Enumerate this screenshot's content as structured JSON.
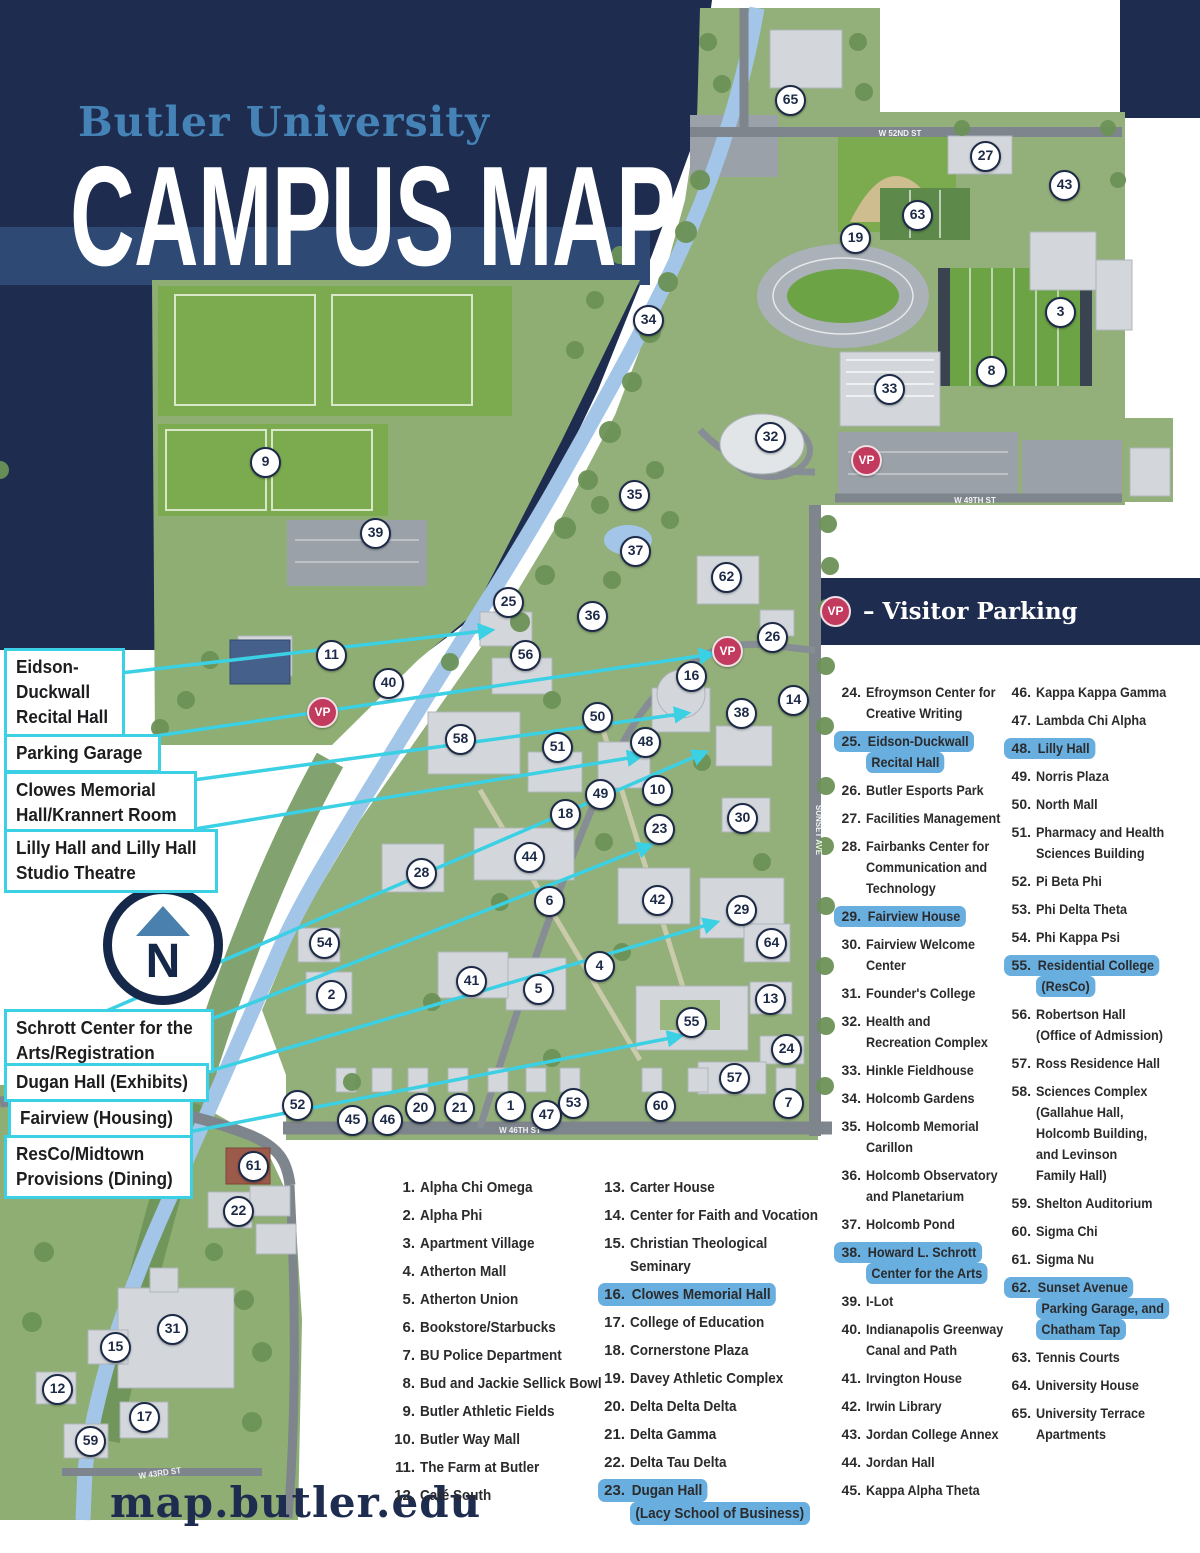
{
  "header": {
    "brand": "Butler University",
    "title": "CAMPUS MAP"
  },
  "legend_vp": {
    "badge": "VP",
    "label": "– Visitor Parking"
  },
  "compass": {
    "letter": "N"
  },
  "footer": {
    "url": "map.butler.edu"
  },
  "colors": {
    "navy": "#1e2c50",
    "band": "#2e4a74",
    "brand_blue": "#4583b6",
    "cyan": "#3bd0e3",
    "vp_red": "#c23a5e",
    "highlight": "#68aede"
  },
  "callouts": [
    {
      "name": "eidson-duckwall-recital-hall",
      "lines": [
        "Eidson-",
        "Duckwall",
        "Recital Hall"
      ],
      "x": 4,
      "y": 648,
      "line": {
        "x1": 60,
        "y1": 680,
        "x2": 492,
        "y2": 630
      }
    },
    {
      "name": "parking-garage",
      "lines": [
        "Parking Garage"
      ],
      "x": 4,
      "y": 734,
      "line": {
        "x1": 60,
        "y1": 750,
        "x2": 713,
        "y2": 654
      }
    },
    {
      "name": "clowes-memorial-hall",
      "lines": [
        "Clowes Memorial",
        "Hall/Krannert Room"
      ],
      "x": 4,
      "y": 771,
      "line": {
        "x1": 60,
        "y1": 798,
        "x2": 688,
        "y2": 713
      }
    },
    {
      "name": "lilly-hall",
      "lines": [
        "Lilly Hall and Lilly Hall",
        "Studio Theatre"
      ],
      "x": 4,
      "y": 829,
      "line": {
        "x1": 60,
        "y1": 851,
        "x2": 641,
        "y2": 756
      }
    },
    {
      "name": "schrott-center",
      "lines": [
        "Schrott Center for the",
        "Arts/Registration"
      ],
      "x": 4,
      "y": 1009,
      "line": {
        "x1": 60,
        "y1": 1031,
        "x2": 706,
        "y2": 752
      }
    },
    {
      "name": "dugan-hall",
      "lines": [
        "Dugan Hall (Exhibits)"
      ],
      "x": 4,
      "y": 1063,
      "line": {
        "x1": 60,
        "y1": 1079,
        "x2": 651,
        "y2": 845
      }
    },
    {
      "name": "fairview-housing",
      "lines": [
        "Fairview (Housing)"
      ],
      "x": 8,
      "y": 1099,
      "line": {
        "x1": 60,
        "y1": 1115,
        "x2": 717,
        "y2": 922
      }
    },
    {
      "name": "resco-midtown",
      "lines": [
        "ResCo/Midtown",
        "Provisions (Dining)"
      ],
      "x": 4,
      "y": 1135,
      "line": {
        "x1": 60,
        "y1": 1157,
        "x2": 681,
        "y2": 1036
      }
    }
  ],
  "legend_columns": [
    {
      "items": [
        {
          "num": "1.",
          "lines": [
            "Alpha Chi Omega"
          ],
          "hl": false
        },
        {
          "num": "2.",
          "lines": [
            "Alpha Phi"
          ],
          "hl": false
        },
        {
          "num": "3.",
          "lines": [
            "Apartment Village"
          ],
          "hl": false
        },
        {
          "num": "4.",
          "lines": [
            "Atherton Mall"
          ],
          "hl": false
        },
        {
          "num": "5.",
          "lines": [
            "Atherton Union"
          ],
          "hl": false
        },
        {
          "num": "6.",
          "lines": [
            "Bookstore/Starbucks"
          ],
          "hl": false
        },
        {
          "num": "7.",
          "lines": [
            "BU Police Department"
          ],
          "hl": false
        },
        {
          "num": "8.",
          "lines": [
            "Bud and Jackie Sellick Bowl"
          ],
          "hl": false
        },
        {
          "num": "9.",
          "lines": [
            "Butler Athletic Fields"
          ],
          "hl": false
        },
        {
          "num": "10.",
          "lines": [
            "Butler Way Mall"
          ],
          "hl": false
        },
        {
          "num": "11.",
          "lines": [
            "The Farm at Butler"
          ],
          "hl": false
        },
        {
          "num": "12.",
          "lines": [
            "Café South"
          ],
          "hl": false
        }
      ]
    },
    {
      "items": [
        {
          "num": "13.",
          "lines": [
            "Carter House"
          ],
          "hl": false
        },
        {
          "num": "14.",
          "lines": [
            "Center for Faith and Vocation"
          ],
          "hl": false
        },
        {
          "num": "15.",
          "lines": [
            "Christian Theological",
            "Seminary"
          ],
          "hl": false
        },
        {
          "num": "16.",
          "lines": [
            "Clowes Memorial Hall"
          ],
          "hl": true
        },
        {
          "num": "17.",
          "lines": [
            "College of Education"
          ],
          "hl": false
        },
        {
          "num": "18.",
          "lines": [
            "Cornerstone Plaza"
          ],
          "hl": false
        },
        {
          "num": "19.",
          "lines": [
            "Davey Athletic Complex"
          ],
          "hl": false
        },
        {
          "num": "20.",
          "lines": [
            "Delta Delta Delta"
          ],
          "hl": false
        },
        {
          "num": "21.",
          "lines": [
            "Delta Gamma"
          ],
          "hl": false
        },
        {
          "num": "22.",
          "lines": [
            "Delta Tau Delta"
          ],
          "hl": false
        },
        {
          "num": "23.",
          "lines": [
            "Dugan Hall",
            "(Lacy School of Business)"
          ],
          "hl": true
        }
      ]
    },
    {
      "items": [
        {
          "num": "24.",
          "lines": [
            "Efroymson Center for",
            "Creative Writing"
          ],
          "hl": false
        },
        {
          "num": "25.",
          "lines": [
            "Eidson-Duckwall",
            "Recital Hall"
          ],
          "hl": true
        },
        {
          "num": "26.",
          "lines": [
            "Butler Esports Park"
          ],
          "hl": false
        },
        {
          "num": "27.",
          "lines": [
            "Facilities Management"
          ],
          "hl": false
        },
        {
          "num": "28.",
          "lines": [
            "Fairbanks Center for",
            "Communication and",
            "Technology"
          ],
          "hl": false
        },
        {
          "num": "29.",
          "lines": [
            "Fairview House"
          ],
          "hl": true
        },
        {
          "num": "30.",
          "lines": [
            "Fairview Welcome",
            "Center"
          ],
          "hl": false
        },
        {
          "num": "31.",
          "lines": [
            "Founder's College"
          ],
          "hl": false
        },
        {
          "num": "32.",
          "lines": [
            "Health and",
            "Recreation Complex"
          ],
          "hl": false
        },
        {
          "num": "33.",
          "lines": [
            "Hinkle Fieldhouse"
          ],
          "hl": false
        },
        {
          "num": "34.",
          "lines": [
            "Holcomb Gardens"
          ],
          "hl": false
        },
        {
          "num": "35.",
          "lines": [
            "Holcomb Memorial",
            "Carillon"
          ],
          "hl": false
        },
        {
          "num": "36.",
          "lines": [
            "Holcomb Observatory",
            "and Planetarium"
          ],
          "hl": false
        },
        {
          "num": "37.",
          "lines": [
            "Holcomb Pond"
          ],
          "hl": false
        },
        {
          "num": "38.",
          "lines": [
            "Howard L. Schrott",
            "Center for the Arts"
          ],
          "hl": true
        },
        {
          "num": "39.",
          "lines": [
            "I-Lot"
          ],
          "hl": false
        },
        {
          "num": "40.",
          "lines": [
            "Indianapolis Greenway",
            "Canal and Path"
          ],
          "hl": false
        },
        {
          "num": "41.",
          "lines": [
            "Irvington House"
          ],
          "hl": false
        },
        {
          "num": "42.",
          "lines": [
            "Irwin Library"
          ],
          "hl": false
        },
        {
          "num": "43.",
          "lines": [
            "Jordan College Annex"
          ],
          "hl": false
        },
        {
          "num": "44.",
          "lines": [
            "Jordan Hall"
          ],
          "hl": false
        },
        {
          "num": "45.",
          "lines": [
            "Kappa Alpha Theta"
          ],
          "hl": false
        }
      ]
    },
    {
      "items": [
        {
          "num": "46.",
          "lines": [
            "Kappa Kappa Gamma"
          ],
          "hl": false
        },
        {
          "num": "47.",
          "lines": [
            "Lambda Chi Alpha"
          ],
          "hl": false
        },
        {
          "num": "48.",
          "lines": [
            "Lilly Hall"
          ],
          "hl": true
        },
        {
          "num": "49.",
          "lines": [
            "Norris Plaza"
          ],
          "hl": false
        },
        {
          "num": "50.",
          "lines": [
            "North Mall"
          ],
          "hl": false
        },
        {
          "num": "51.",
          "lines": [
            "Pharmacy and Health",
            "Sciences Building"
          ],
          "hl": false
        },
        {
          "num": "52.",
          "lines": [
            "Pi Beta Phi"
          ],
          "hl": false
        },
        {
          "num": "53.",
          "lines": [
            "Phi Delta Theta"
          ],
          "hl": false
        },
        {
          "num": "54.",
          "lines": [
            "Phi Kappa Psi"
          ],
          "hl": false
        },
        {
          "num": "55.",
          "lines": [
            "Residential College",
            "(ResCo)"
          ],
          "hl": true
        },
        {
          "num": "56.",
          "lines": [
            "Robertson Hall",
            "(Office of Admission)"
          ],
          "hl": false
        },
        {
          "num": "57.",
          "lines": [
            "Ross Residence Hall"
          ],
          "hl": false
        },
        {
          "num": "58.",
          "lines": [
            "Sciences Complex",
            "(Gallahue Hall,",
            "Holcomb Building,",
            "and Levinson",
            "Family Hall)"
          ],
          "hl": false
        },
        {
          "num": "59.",
          "lines": [
            "Shelton Auditorium"
          ],
          "hl": false
        },
        {
          "num": "60.",
          "lines": [
            "Sigma Chi"
          ],
          "hl": false
        },
        {
          "num": "61.",
          "lines": [
            "Sigma Nu"
          ],
          "hl": false
        },
        {
          "num": "62.",
          "lines": [
            "Sunset Avenue",
            "Parking Garage, and",
            "Chatham Tap"
          ],
          "hl": true
        },
        {
          "num": "63.",
          "lines": [
            "Tennis Courts"
          ],
          "hl": false
        },
        {
          "num": "64.",
          "lines": [
            "University House"
          ],
          "hl": false
        },
        {
          "num": "65.",
          "lines": [
            "University Terrace",
            "Apartments"
          ],
          "hl": false
        }
      ]
    }
  ],
  "map": {
    "markers": [
      {
        "n": "1",
        "x": 510,
        "y": 1106
      },
      {
        "n": "2",
        "x": 331,
        "y": 995
      },
      {
        "n": "3",
        "x": 1060,
        "y": 312
      },
      {
        "n": "4",
        "x": 599,
        "y": 966
      },
      {
        "n": "5",
        "x": 538,
        "y": 989
      },
      {
        "n": "6",
        "x": 549,
        "y": 901
      },
      {
        "n": "7",
        "x": 788,
        "y": 1103
      },
      {
        "n": "8",
        "x": 991,
        "y": 371
      },
      {
        "n": "9",
        "x": 265,
        "y": 462
      },
      {
        "n": "10",
        "x": 657,
        "y": 790
      },
      {
        "n": "11",
        "x": 331,
        "y": 655
      },
      {
        "n": "12",
        "x": 57,
        "y": 1389
      },
      {
        "n": "13",
        "x": 770,
        "y": 999
      },
      {
        "n": "14",
        "x": 793,
        "y": 700
      },
      {
        "n": "15",
        "x": 115,
        "y": 1347
      },
      {
        "n": "16",
        "x": 691,
        "y": 676
      },
      {
        "n": "17",
        "x": 144,
        "y": 1417
      },
      {
        "n": "18",
        "x": 565,
        "y": 814
      },
      {
        "n": "19",
        "x": 855,
        "y": 238
      },
      {
        "n": "20",
        "x": 420,
        "y": 1108
      },
      {
        "n": "21",
        "x": 459,
        "y": 1108
      },
      {
        "n": "22",
        "x": 238,
        "y": 1211
      },
      {
        "n": "23",
        "x": 659,
        "y": 829
      },
      {
        "n": "24",
        "x": 786,
        "y": 1049
      },
      {
        "n": "25",
        "x": 508,
        "y": 602
      },
      {
        "n": "26",
        "x": 772,
        "y": 637
      },
      {
        "n": "27",
        "x": 985,
        "y": 156
      },
      {
        "n": "28",
        "x": 421,
        "y": 873
      },
      {
        "n": "29",
        "x": 741,
        "y": 910
      },
      {
        "n": "30",
        "x": 742,
        "y": 818
      },
      {
        "n": "31",
        "x": 172,
        "y": 1329
      },
      {
        "n": "32",
        "x": 770,
        "y": 437
      },
      {
        "n": "33",
        "x": 889,
        "y": 389
      },
      {
        "n": "34",
        "x": 648,
        "y": 320
      },
      {
        "n": "35",
        "x": 634,
        "y": 495
      },
      {
        "n": "36",
        "x": 592,
        "y": 616
      },
      {
        "n": "37",
        "x": 635,
        "y": 551
      },
      {
        "n": "38",
        "x": 741,
        "y": 713
      },
      {
        "n": "39",
        "x": 375,
        "y": 533
      },
      {
        "n": "40",
        "x": 388,
        "y": 683
      },
      {
        "n": "41",
        "x": 471,
        "y": 981
      },
      {
        "n": "42",
        "x": 657,
        "y": 900
      },
      {
        "n": "43",
        "x": 1064,
        "y": 185
      },
      {
        "n": "44",
        "x": 529,
        "y": 857
      },
      {
        "n": "45",
        "x": 352,
        "y": 1120
      },
      {
        "n": "46",
        "x": 387,
        "y": 1120
      },
      {
        "n": "47",
        "x": 546,
        "y": 1115
      },
      {
        "n": "48",
        "x": 645,
        "y": 742
      },
      {
        "n": "49",
        "x": 600,
        "y": 794
      },
      {
        "n": "50",
        "x": 597,
        "y": 717
      },
      {
        "n": "51",
        "x": 557,
        "y": 747
      },
      {
        "n": "52",
        "x": 297,
        "y": 1105
      },
      {
        "n": "53",
        "x": 573,
        "y": 1103
      },
      {
        "n": "54",
        "x": 324,
        "y": 943
      },
      {
        "n": "55",
        "x": 691,
        "y": 1022
      },
      {
        "n": "56",
        "x": 525,
        "y": 655
      },
      {
        "n": "57",
        "x": 734,
        "y": 1078
      },
      {
        "n": "58",
        "x": 460,
        "y": 739
      },
      {
        "n": "59",
        "x": 90,
        "y": 1441
      },
      {
        "n": "60",
        "x": 660,
        "y": 1106
      },
      {
        "n": "61",
        "x": 253,
        "y": 1166
      },
      {
        "n": "62",
        "x": 726,
        "y": 577
      },
      {
        "n": "63",
        "x": 917,
        "y": 215
      },
      {
        "n": "64",
        "x": 771,
        "y": 943
      },
      {
        "n": "65",
        "x": 790,
        "y": 100
      }
    ],
    "vp_markers": [
      {
        "label": "VP",
        "x": 866,
        "y": 460
      },
      {
        "label": "VP",
        "x": 727,
        "y": 651
      },
      {
        "label": "VP",
        "x": 322,
        "y": 712
      }
    ],
    "street_labels": [
      {
        "text": "W 52ND ST",
        "x": 900,
        "y": 134,
        "rot": 0
      },
      {
        "text": "W 49TH ST",
        "x": 975,
        "y": 501,
        "rot": 0
      },
      {
        "text": "SUNSET AVE",
        "x": 818,
        "y": 830,
        "rot": 90
      },
      {
        "text": "W 46TH ST",
        "x": 520,
        "y": 1131,
        "rot": 0
      },
      {
        "text": "W 43RD ST",
        "x": 160,
        "y": 1474,
        "rot": -8
      }
    ]
  }
}
